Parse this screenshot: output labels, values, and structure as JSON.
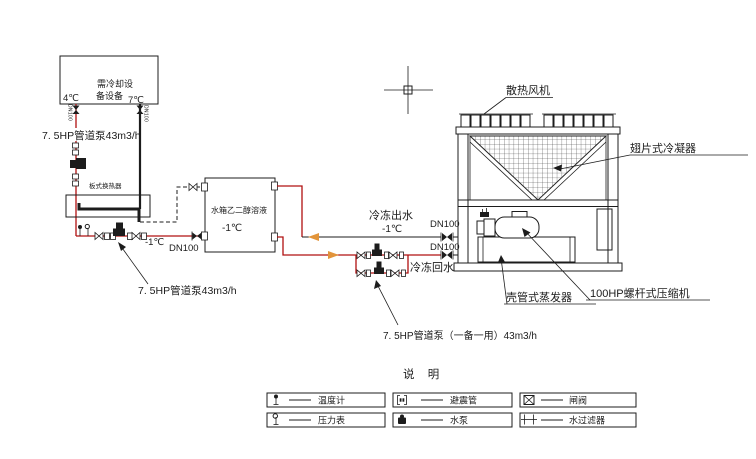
{
  "colors": {
    "pipe_red": "#b01010",
    "flow_arrow_orange": "#e2943a",
    "line_black": "#1c1c1c",
    "background": "#ffffff"
  },
  "cooling_load": {
    "label_line1": "需冷却设",
    "label_line2": "备设备",
    "temp_out": "4℃",
    "temp_in": "7℃",
    "pipe_dn": "DN100"
  },
  "left_circuit": {
    "pump_label": "7. 5HP管道泵43m3/h",
    "exchanger_label": "板式换热器"
  },
  "glycol_circuit": {
    "pump_label": "7. 5HP管道泵43m3/h",
    "temp": "-1℃",
    "dn": "DN100"
  },
  "tank": {
    "name": "水箱乙二醇溶液",
    "temp": "-1℃"
  },
  "supply_line": {
    "name": "冷冻出水",
    "temp": "-1℃",
    "dn": "DN100"
  },
  "return_line": {
    "name": "冷冻回水",
    "dn": "DN100",
    "pump_label": "7. 5HP管道泵（一备一用）43m3/h"
  },
  "chiller": {
    "fan_label": "散热风机",
    "condenser_label": "翅片式冷凝器",
    "evaporator_label": "壳管式蒸发器",
    "compressor_label": "100HP螺杆式压缩机"
  },
  "legend": {
    "title": "说 明",
    "items": [
      {
        "icon": "thermometer-icon",
        "label": "温度计"
      },
      {
        "icon": "flex-connector-icon",
        "label": "避震管"
      },
      {
        "icon": "gate-valve-icon",
        "label": "闸阀"
      },
      {
        "icon": "pressure-gauge-icon",
        "label": "压力表"
      },
      {
        "icon": "pump-icon",
        "label": "水泵"
      },
      {
        "icon": "filter-icon",
        "label": "水过滤器"
      }
    ]
  }
}
